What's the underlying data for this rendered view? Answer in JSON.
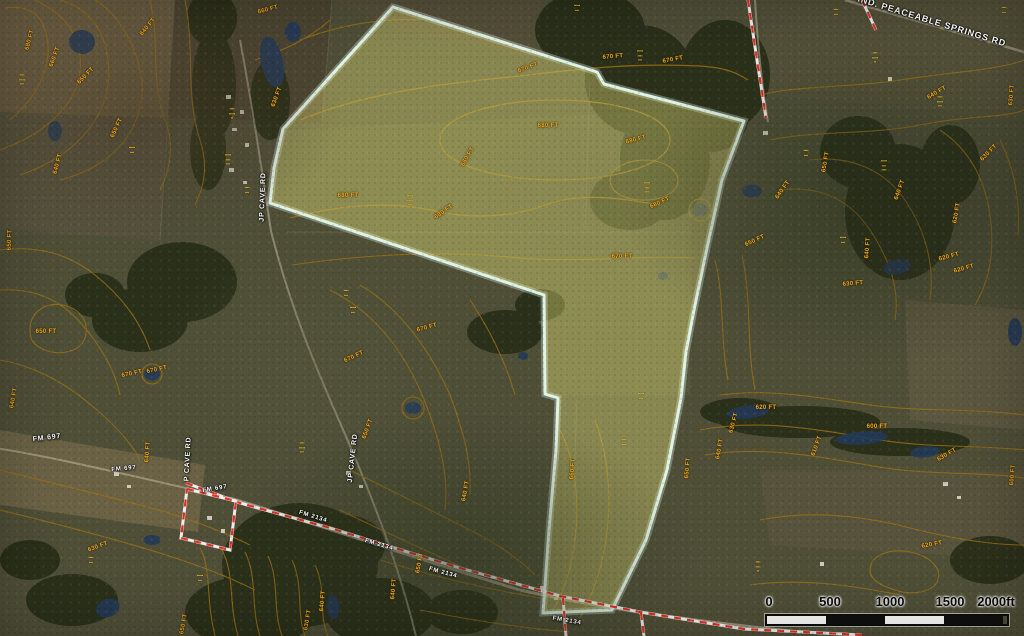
{
  "colors": {
    "base_terrain": "#4f4f38",
    "parcel_outline": "#dff3e7",
    "parcel_fill": "rgba(226,221,120,0.40)",
    "contour_line": "#9a6f15",
    "contour_label": "#f2a91e",
    "boundary_red": "#e03127",
    "boundary_white": "#f5f5f5",
    "road_label": "#ffffff",
    "owner_label": "#f7c52d",
    "water": "#243a58"
  },
  "parcel": {
    "description": "highlighted subject property outlined in pale mint with translucent yellow fill",
    "points": [
      [
        393,
        7
      ],
      [
        597,
        72
      ],
      [
        604,
        84
      ],
      [
        744,
        121
      ],
      [
        722,
        180
      ],
      [
        707,
        248
      ],
      [
        694,
        310
      ],
      [
        686,
        352
      ],
      [
        681,
        398
      ],
      [
        667,
        470
      ],
      [
        646,
        540
      ],
      [
        612,
        610
      ],
      [
        543,
        613
      ],
      [
        549,
        530
      ],
      [
        556,
        450
      ],
      [
        558,
        398
      ],
      [
        545,
        394
      ],
      [
        544,
        295
      ],
      [
        270,
        203
      ],
      [
        274,
        168
      ],
      [
        283,
        129
      ]
    ]
  },
  "boundaries": {
    "description": "red-and-white dashed survey/road boundary lines",
    "items": [
      [
        [
          748,
          0
        ],
        [
          757,
          60
        ],
        [
          766,
          118
        ]
      ],
      [
        [
          862,
          0
        ],
        [
          876,
          30
        ]
      ],
      [
        [
          186,
          483
        ],
        [
          240,
          503
        ],
        [
          330,
          528
        ],
        [
          460,
          568
        ],
        [
          560,
          596
        ],
        [
          640,
          612
        ],
        [
          744,
          629
        ],
        [
          862,
          635
        ]
      ],
      [
        [
          187,
          489
        ],
        [
          236,
          501
        ],
        [
          230,
          550
        ],
        [
          181,
          538
        ],
        [
          187,
          489
        ]
      ],
      [
        [
          563,
          598
        ],
        [
          566,
          636
        ]
      ],
      [
        [
          641,
          613
        ],
        [
          644,
          636
        ]
      ]
    ]
  },
  "contour_labels": {
    "fields": [
      "text",
      "x",
      "y",
      "rotation_deg"
    ],
    "items": [
      [
        "680 FT",
        30,
        40,
        -75
      ],
      [
        "660 FT",
        55,
        57,
        -70
      ],
      [
        "650 FT",
        86,
        76,
        -45
      ],
      [
        "640 FT",
        148,
        27,
        -50
      ],
      [
        "660 FT",
        268,
        10,
        -15
      ],
      [
        "630 FT",
        277,
        97,
        -70
      ],
      [
        "650 FT",
        117,
        128,
        -65
      ],
      [
        "640 FT",
        58,
        164,
        -75
      ],
      [
        "650 FT",
        10,
        240,
        -88
      ],
      [
        "650 FT",
        46,
        332,
        0
      ],
      [
        "670 FT",
        132,
        374,
        -12
      ],
      [
        "670 FT",
        157,
        370,
        -12
      ],
      [
        "640 FT",
        148,
        452,
        -85
      ],
      [
        "640 FT",
        14,
        398,
        -80
      ],
      [
        "630 FT",
        98,
        547,
        -20
      ],
      [
        "640 FT",
        323,
        601,
        -85
      ],
      [
        "630 FT",
        308,
        620,
        -80
      ],
      [
        "650 FT",
        184,
        624,
        -80
      ],
      [
        "640 FT",
        394,
        589,
        -85
      ],
      [
        "650 FT",
        420,
        563,
        -80
      ],
      [
        "670 FT",
        528,
        68,
        -20
      ],
      [
        "670 FT",
        613,
        57,
        -5
      ],
      [
        "670 FT",
        673,
        60,
        -10
      ],
      [
        "680 FT",
        548,
        126,
        0
      ],
      [
        "680 FT",
        636,
        140,
        -15
      ],
      [
        "660 FT",
        468,
        157,
        -60
      ],
      [
        "680 FT",
        348,
        196,
        0
      ],
      [
        "680 FT",
        444,
        212,
        -35
      ],
      [
        "680 FT",
        660,
        203,
        -25
      ],
      [
        "670 FT",
        622,
        257,
        0
      ],
      [
        "670 FT",
        427,
        328,
        -15
      ],
      [
        "670 FT",
        354,
        357,
        -25
      ],
      [
        "650 FT",
        368,
        429,
        -70
      ],
      [
        "660 FT",
        573,
        469,
        -85
      ],
      [
        "640 FT",
        466,
        491,
        -80
      ],
      [
        "650 FT",
        688,
        468,
        -85
      ],
      [
        "650 FT",
        755,
        241,
        -25
      ],
      [
        "640 FT",
        783,
        190,
        -55
      ],
      [
        "650 FT",
        826,
        162,
        -80
      ],
      [
        "640 FT",
        900,
        190,
        -70
      ],
      [
        "640 FT",
        868,
        248,
        -85
      ],
      [
        "630 FT",
        853,
        284,
        -5
      ],
      [
        "620 FT",
        949,
        257,
        -15
      ],
      [
        "620 FT",
        964,
        269,
        -15
      ],
      [
        "630 FT",
        989,
        153,
        -45
      ],
      [
        "620 FT",
        957,
        213,
        -80
      ],
      [
        "640 FT",
        937,
        93,
        -30
      ],
      [
        "630 FT",
        1012,
        95,
        -85
      ],
      [
        "620 FT",
        766,
        408,
        0
      ],
      [
        "630 FT",
        734,
        423,
        -75
      ],
      [
        "600 FT",
        877,
        427,
        0
      ],
      [
        "640 FT",
        720,
        449,
        -80
      ],
      [
        "610 FT",
        817,
        446,
        -70
      ],
      [
        "620 FT",
        932,
        545,
        -10
      ],
      [
        "630 FT",
        947,
        455,
        -30
      ],
      [
        "600 FT",
        1013,
        475,
        -85
      ]
    ]
  },
  "road_labels": {
    "fields": [
      "text",
      "x",
      "y",
      "rotation_deg",
      "font_px"
    ],
    "items": [
      [
        "IND. PEACEABLE SPRINGS RD",
        932,
        21,
        17,
        9
      ],
      [
        "JP CAVE RD",
        263,
        197,
        -88,
        7
      ],
      [
        "JP CAVE RD",
        353,
        458,
        -84,
        7
      ],
      [
        "P CAVE RD",
        188,
        459,
        -87,
        7
      ],
      [
        "FM 697",
        47,
        438,
        -7,
        7
      ],
      [
        "FM 697",
        124,
        469,
        -5,
        6
      ],
      [
        "FM 697",
        215,
        489,
        -9,
        6
      ],
      [
        "FM 2134",
        313,
        517,
        17,
        6
      ],
      [
        "FM 2134",
        379,
        545,
        16,
        6
      ],
      [
        "FM 2134",
        443,
        573,
        15,
        6
      ],
      [
        "FM 2134",
        567,
        621,
        10,
        6
      ]
    ]
  },
  "owner_labels": {
    "description": "tiny yellow parcel-owner text blocks, illegible at this resolution",
    "fields": [
      "x",
      "y",
      "lines"
    ],
    "items": [
      [
        22,
        80,
        [
          "▪▪▪▪",
          "▪▪▪▪▪",
          "▪▪▪"
        ]
      ],
      [
        132,
        150,
        [
          "▪▪▪▪▪",
          "▪▪▪"
        ]
      ],
      [
        232,
        114,
        [
          "▪▪▪▪",
          "▪▪▪▪▪",
          "▪▪"
        ]
      ],
      [
        228,
        160,
        [
          "▪▪▪▪▪",
          "▪▪▪▪",
          "▪▪▪"
        ]
      ],
      [
        247,
        190,
        [
          "▪▪▪▪",
          "▪▪▪"
        ]
      ],
      [
        410,
        201,
        [
          "▪▪▪▪▪",
          "▪▪▪▪▪▪",
          "▪▪▪▪"
        ]
      ],
      [
        577,
        8,
        [
          "▪▪▪▪▪",
          "▪▪▪"
        ]
      ],
      [
        640,
        56,
        [
          "▪▪▪▪▪",
          "▪▪▪▪",
          "▪▪▪"
        ]
      ],
      [
        836,
        12,
        [
          "▪▪▪▪",
          "▪▪▪"
        ]
      ],
      [
        1004,
        10,
        [
          "▪▪▪▪",
          "▪▪▪"
        ]
      ],
      [
        875,
        58,
        [
          "▪▪▪▪",
          "▪▪▪▪▪",
          "▪▪"
        ]
      ],
      [
        884,
        166,
        [
          "▪▪▪▪▪",
          "▪▪▪",
          "▪▪▪▪"
        ]
      ],
      [
        806,
        153,
        [
          "▪▪▪▪",
          "▪▪▪"
        ]
      ],
      [
        647,
        188,
        [
          "▪▪▪▪▪",
          "▪▪▪▪",
          "▪▪▪"
        ]
      ],
      [
        346,
        293,
        [
          "▪▪▪▪",
          "▪▪▪"
        ]
      ],
      [
        353,
        310,
        [
          "▪▪▪▪▪",
          "▪▪▪"
        ]
      ],
      [
        302,
        448,
        [
          "▪▪▪▪",
          "▪▪▪▪▪",
          "▪▪▪"
        ]
      ],
      [
        200,
        578,
        [
          "▪▪▪▪▪",
          "▪▪▪"
        ]
      ],
      [
        758,
        567,
        [
          "▪▪▪▪",
          "▪▪▪▪",
          "▪▪"
        ]
      ],
      [
        843,
        240,
        [
          "▪▪▪▪▪",
          "▪▪▪"
        ]
      ],
      [
        940,
        102,
        [
          "▪▪▪▪",
          "▪▪▪▪▪",
          "▪▪▪"
        ]
      ],
      [
        641,
        396,
        [
          "▪▪▪▪▪",
          "▪▪▪"
        ]
      ],
      [
        624,
        442,
        [
          "▪▪▪▪",
          "▪▪▪"
        ]
      ],
      [
        91,
        560,
        [
          "▪▪▪▪",
          "▪▪▪"
        ]
      ]
    ]
  },
  "water": {
    "fields": [
      "cx",
      "cy",
      "w",
      "h",
      "rotation_deg"
    ],
    "items": [
      [
        82,
        42,
        26,
        24,
        10
      ],
      [
        272,
        62,
        22,
        52,
        -12
      ],
      [
        293,
        32,
        16,
        20,
        0
      ],
      [
        55,
        131,
        14,
        20,
        0
      ],
      [
        152,
        374,
        16,
        13,
        0
      ],
      [
        413,
        408,
        16,
        12,
        0
      ],
      [
        523,
        356,
        10,
        8,
        0
      ],
      [
        700,
        210,
        16,
        13,
        0
      ],
      [
        752,
        191,
        20,
        13,
        0
      ],
      [
        663,
        276,
        10,
        8,
        0
      ],
      [
        897,
        267,
        28,
        15,
        -10
      ],
      [
        748,
        412,
        42,
        13,
        -6
      ],
      [
        862,
        438,
        52,
        13,
        -4
      ],
      [
        925,
        452,
        30,
        11,
        -6
      ],
      [
        152,
        540,
        17,
        10,
        0
      ],
      [
        108,
        608,
        24,
        18,
        -20
      ],
      [
        333,
        607,
        13,
        24,
        -5
      ],
      [
        1015,
        332,
        14,
        28,
        0
      ]
    ]
  },
  "scale_bar": {
    "ticks": [
      "0",
      "500",
      "1000",
      "1500",
      "2000ft"
    ],
    "segments": [
      "#f8f8f6",
      "#101010",
      "#f8f8f6",
      "#101010"
    ]
  }
}
